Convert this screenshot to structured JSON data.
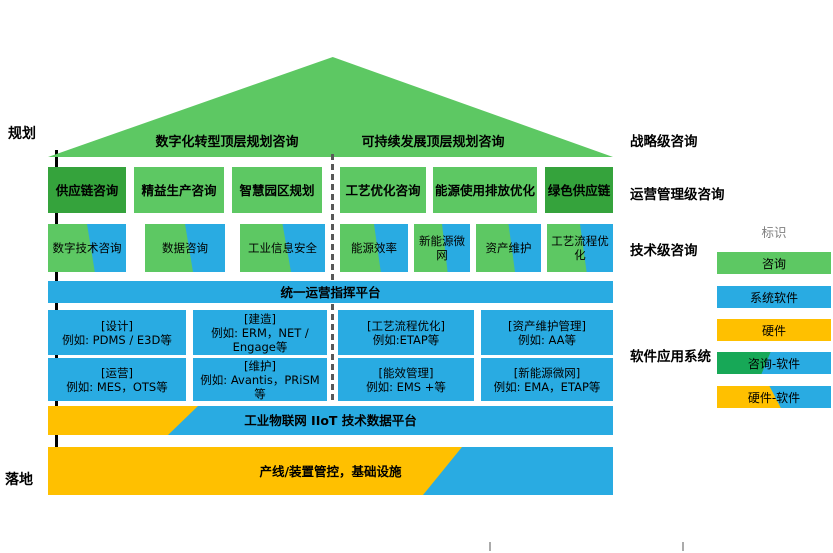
{
  "colors": {
    "light_green": "#5DC863",
    "dark_green": "#35A33C",
    "emerald_green": "#17A857",
    "blue": "#29ABE2",
    "yellow": "#FFC000",
    "dash_gray": "#595959",
    "legend_title_gray": "#7F7F7F"
  },
  "left_axis": {
    "top_label": "规划",
    "bottom_label": "落地"
  },
  "roof": {
    "left_title": "数字化转型顶层规划咨询",
    "right_title": "可持续发展顶层规划咨询"
  },
  "right_labels": {
    "strategic": "战略级咨询",
    "operation": "运营管理级咨询",
    "technical": "技术级咨询",
    "software": "软件应用系统"
  },
  "row1": {
    "items": [
      "供应链咨询",
      "精益生产咨询",
      "智慧园区规划",
      "工艺优化咨询",
      "能源使用排放优化",
      "绿色供应链"
    ]
  },
  "row2": {
    "items": [
      "数字技术咨询",
      "数据咨询",
      "工业信息安全",
      "能源效率",
      "新能源微网",
      "资产维护",
      "工艺流程优化"
    ]
  },
  "bands": {
    "unified": "统一运营指挥平台",
    "iiot": "工业物联网 IIoT 技术数据平台",
    "infra": "产线/装置管控，基础设施"
  },
  "software": [
    {
      "title": "[设计]",
      "example": "例如: PDMS / E3D等"
    },
    {
      "title": "[建造]",
      "example": "例如: ERM，NET / Engage等"
    },
    {
      "title": "[工艺流程优化]",
      "example": "例如:ETAP等"
    },
    {
      "title": "[资产维护管理]",
      "example": "例如: AA等"
    },
    {
      "title": "[运营]",
      "example": "例如: MES，OTS等"
    },
    {
      "title": "[维护]",
      "example": "例如: Avantis，PRiSM等"
    },
    {
      "title": "[能效管理]",
      "example": "例如: EMS +等"
    },
    {
      "title": "[新能源微网]",
      "example": "例如: EMA，ETAP等"
    }
  ],
  "legend": {
    "title": "标识",
    "items": [
      "咨询",
      "系统软件",
      "硬件",
      "咨询-软件",
      "硬件-软件"
    ]
  }
}
